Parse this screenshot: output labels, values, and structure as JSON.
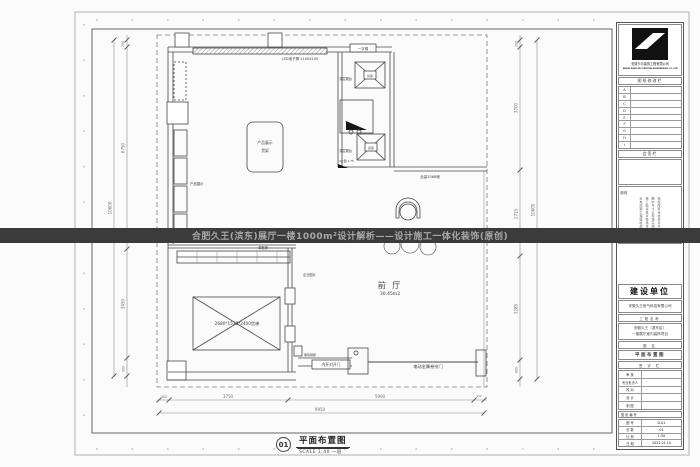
{
  "watermark": {
    "text": "合肥久王(滨东)展厅一楼1000m²设计解析——设计施工一体化装饰(原创)"
  },
  "sheet_title": {
    "num": "01",
    "name": "平面布置图",
    "scale": "SCALE 1:40  一层"
  },
  "plan": {
    "labels": {
      "led": "LED电子屏 1100X100",
      "top_door": "一字梯",
      "shelf_left": "产品展示",
      "island1": "产品展示",
      "island2": "货架",
      "double_stand1": "双层展台",
      "double_stand2": "双层展台",
      "col1": "货架",
      "col2": "货架",
      "elev_mark": "A立面 1:75",
      "wall_label": "全高3368墙",
      "hall": "前 厅",
      "hall_area": "30.45m2",
      "stair": "单跑梯",
      "photos": "企业图片",
      "lift": "2680*1530*2400货梯",
      "glass": "玻璃隔断",
      "door": "内开对开门",
      "rolldoor": "电动金属卷帘门"
    },
    "dims": {
      "left": [
        "200",
        "6750",
        "3450",
        "300"
      ],
      "left_total": "10600",
      "right": [
        "200",
        "3700",
        "2715",
        "3285",
        "600"
      ],
      "right_total": "10600",
      "bottom": [
        "300",
        "3750",
        "5900",
        "150"
      ],
      "bottom_total": "9950"
    }
  },
  "titleblock": {
    "logo_company_cn": "安徽卡尔装饰工程有限公司",
    "logo_company_en": "ANHUI KAER DECORATION ENGINEERING CO.,LTD",
    "revision_header": "图纸修改栏",
    "revision_rows": [
      "A",
      "B",
      "C",
      "D",
      "E",
      "F",
      "G",
      "H",
      "I"
    ],
    "sign_header": "会签栏",
    "notes_header": "说明",
    "notes": [
      "版权所有未经许可不得复制",
      "图中尺寸以现场实测为准",
      "施工前请核对现场尺寸",
      "水电隐蔽工程验收后施工"
    ],
    "client_header": "建设单位",
    "client_name": "安徽久王电气科技有限公司",
    "project_label": "工程名称",
    "project_name1": "安徽久王（滨东区）",
    "project_name2": "一楼展厅室内装饰项目",
    "drawing_label": "图  名",
    "drawing_name": "平面布置图",
    "sign_col_header": "签 字 栏",
    "sign_rows": [
      "审  核",
      "专业负责人",
      "校  对",
      "设  计",
      "制  图"
    ],
    "number_header": "图纸编号",
    "meta": [
      [
        "图 号",
        "D-01"
      ],
      [
        "页 数",
        "01"
      ],
      [
        "比 例",
        "1:50"
      ],
      [
        "日 期",
        "2022.01.10"
      ]
    ]
  }
}
